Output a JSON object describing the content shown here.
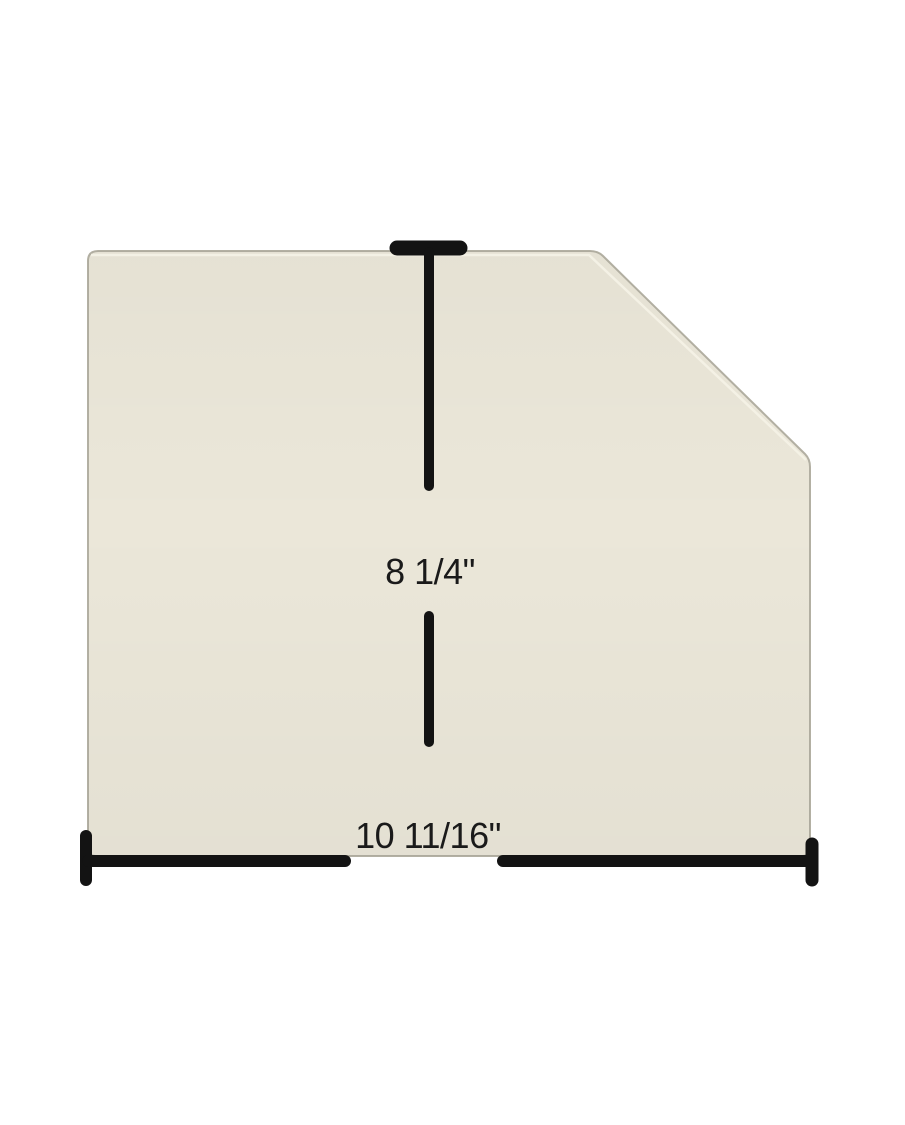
{
  "labels": {
    "height": "8 1/4\"",
    "width": "10 11/16\""
  },
  "colors": {
    "background": "#ffffff",
    "glass_fill": "#ebe7d9",
    "glass_edge": "#b3b0a3",
    "glass_bevel_highlight": "#f6f3e8",
    "dimension_line": "#131313",
    "label_text": "#1a1a1a"
  }
}
